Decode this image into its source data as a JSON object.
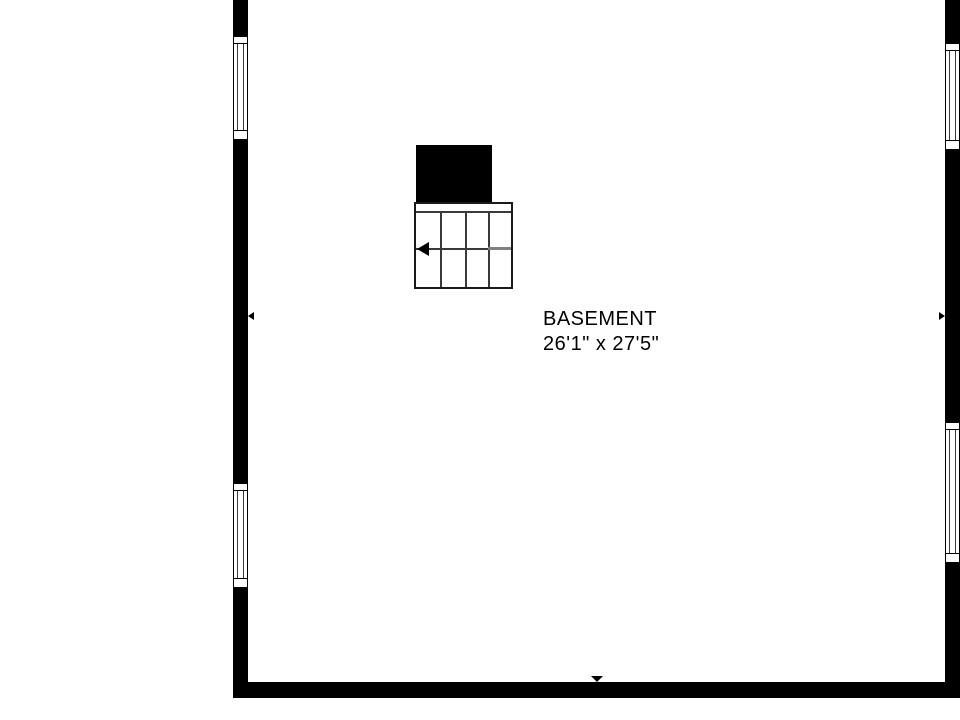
{
  "floor_plan": {
    "room": {
      "name": "BASEMENT",
      "dimensions": "26'1\" x 27'5\""
    },
    "colors": {
      "wall": "#000000",
      "line": "#3a3a3a",
      "line_strong": "#1a1a1a",
      "stair_rail": "#808080",
      "background": "#ffffff",
      "text": "#000000"
    }
  }
}
